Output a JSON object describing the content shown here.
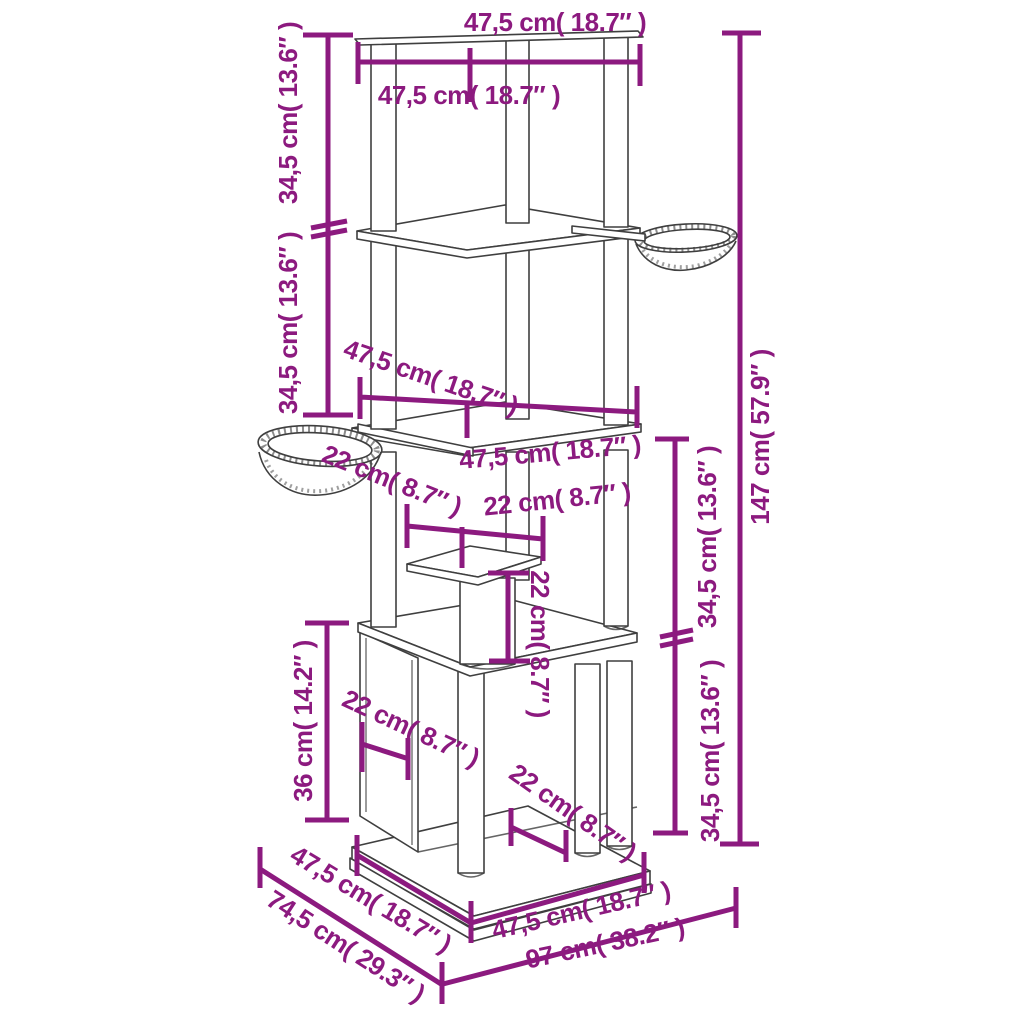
{
  "diagram": {
    "colors": {
      "dimension_accent": "#8c1a7f",
      "drawing_line": "#3f3f3f",
      "background": "#ffffff"
    },
    "labels": {
      "top_width": "47,5 cm( 18.7″ )",
      "upper_shelf_width": "47,5 cm( 18.7″ )",
      "upper_section_height": "34,5 cm( 13.6″ )",
      "second_section_height": "34,5 cm( 13.6″ )",
      "middle_shelf_width": "47,5 cm( 18.7″ )",
      "lower_platform_width": "47,5 cm( 18.7″ )",
      "right_upper_section_height": "34,5 cm( 13.6″ )",
      "right_lower_section_height": "34,5 cm( 13.6″ )",
      "total_height": "147 cm( 57.9″ )",
      "basket_diameter": "22 cm( 8.7″ )",
      "small_shelf_width": "22 cm( 8.7″ )",
      "small_post_height": "22 cm( 8.7″ )",
      "condo_height": "36 cm( 14.2″ )",
      "condo_depth": "22 cm( 8.7″ )",
      "base_inset_width": "22 cm( 8.7″ )",
      "base_depth": "47,5 cm( 18.7″ )",
      "total_depth": "74,5 cm( 29.3″ )",
      "base_width": "47,5 cm( 18.7″ )",
      "total_width": "97 cm( 38.2″ )"
    }
  }
}
